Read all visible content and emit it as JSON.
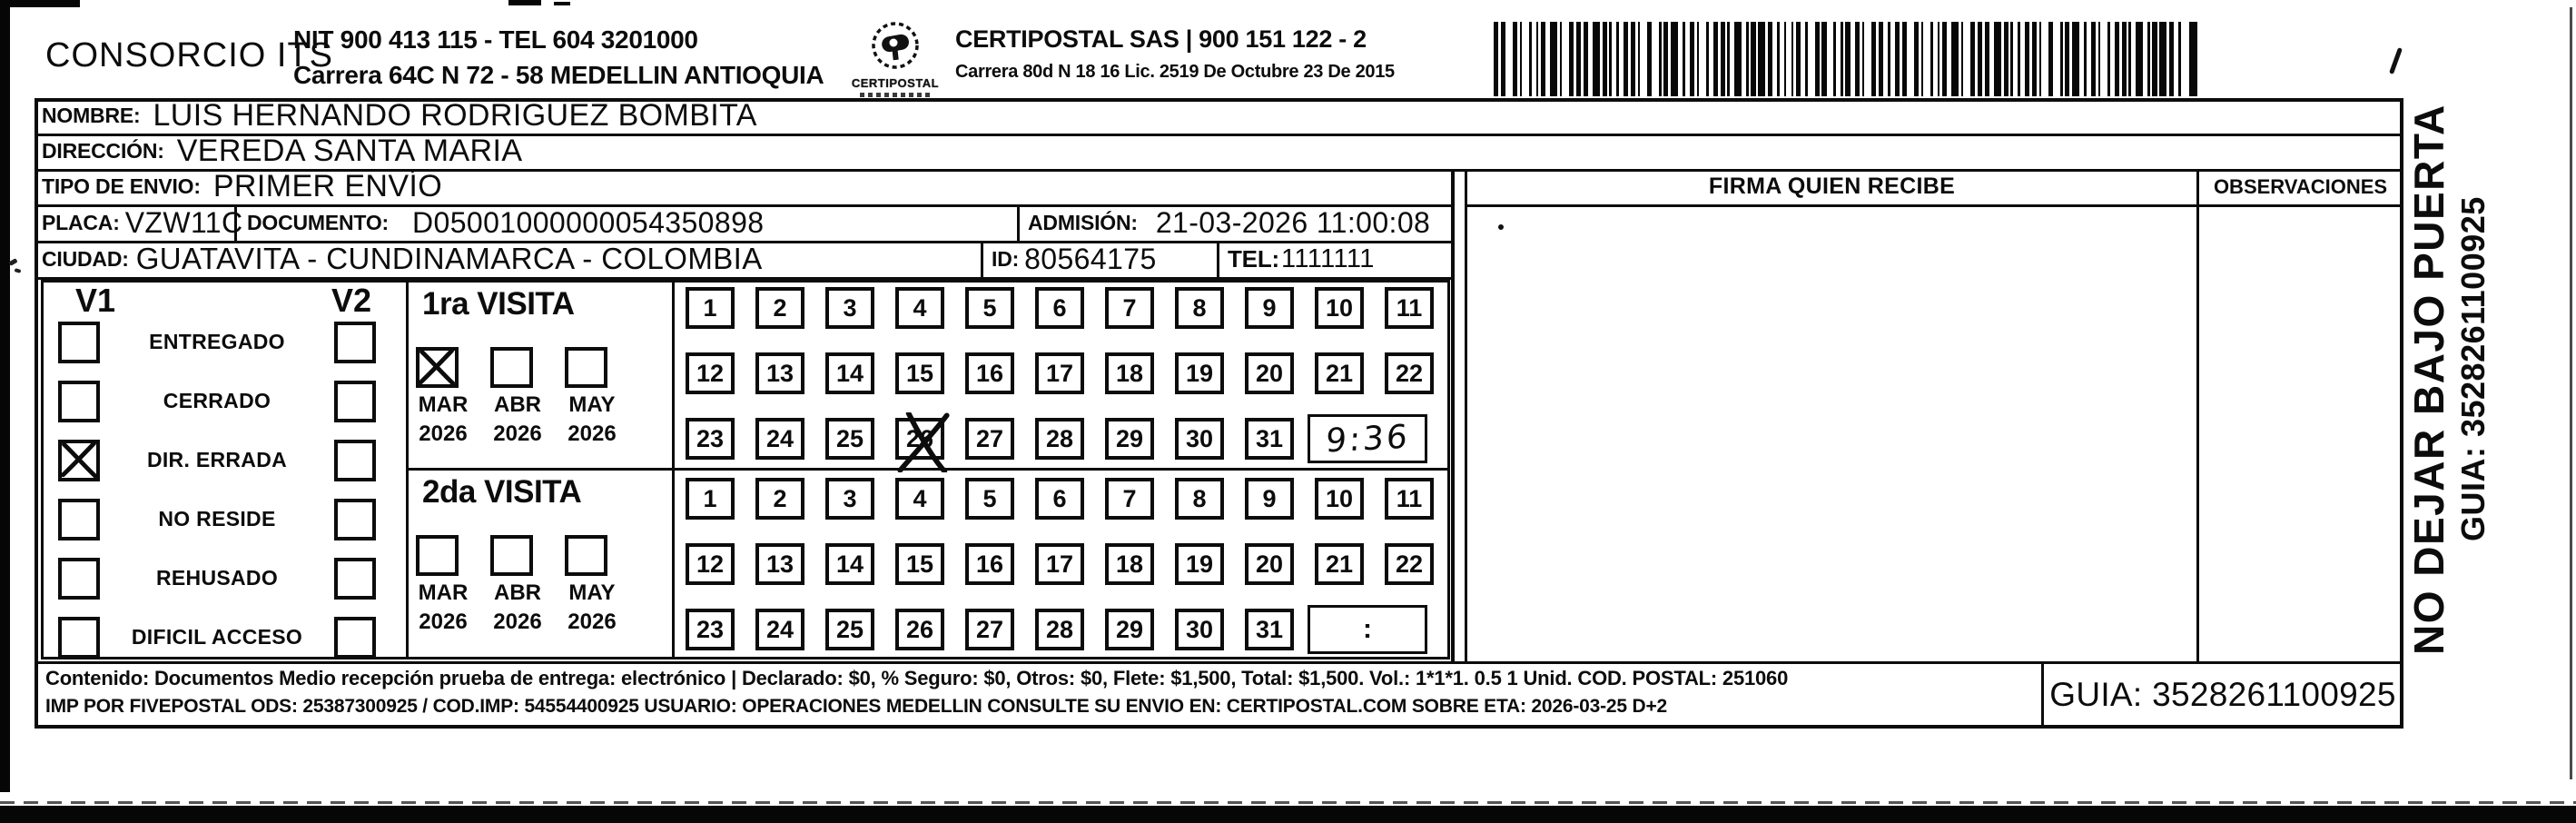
{
  "header": {
    "company_name": "CONSORCIO ITS",
    "nit_line": "NIT 900 413 115 - TEL 604 3201000",
    "address_line": "Carrera 64C N 72 - 58 MEDELLIN ANTIOQUIA",
    "logo_name": "CERTIPOSTAL",
    "operator_line": "CERTIPOSTAL SAS | 900 151 122 - 2",
    "operator_address": "Carrera 80d N 18 16  Lic. 2519 De Octubre 23 De 2015"
  },
  "shipment": {
    "nombre_label": "NOMBRE:",
    "nombre": "LUIS HERNANDO RODRIGUEZ BOMBITA",
    "direccion_label": "DIRECCIÓN:",
    "direccion": "VEREDA SANTA MARIA",
    "tipo_envio_label": "TIPO DE ENVIO:",
    "tipo_envio": "PRIMER ENVÍO",
    "placa_label": "PLACA:",
    "placa": "VZW11C",
    "documento_label": "DOCUMENTO:",
    "documento": "D05001000000054350898",
    "admision_label": "ADMISIÓN:",
    "admision": "21-03-2026 11:00:08",
    "ciudad_label": "CIUDAD:",
    "ciudad": "GUATAVITA - CUNDINAMARCA - COLOMBIA",
    "id_label": "ID:",
    "id_value": "80564175",
    "tel_label": "TEL:",
    "tel": "1111111"
  },
  "columns": {
    "firma_header": "FIRMA QUIEN RECIBE",
    "observaciones_header": "OBSERVACIONES"
  },
  "status_panel": {
    "col1": "V1",
    "col2": "V2",
    "options": [
      {
        "label": "ENTREGADO",
        "v1_checked": false,
        "v2_checked": false
      },
      {
        "label": "CERRADO",
        "v1_checked": false,
        "v2_checked": false
      },
      {
        "label": "DIR. ERRADA",
        "v1_checked": true,
        "v2_checked": false
      },
      {
        "label": "NO RESIDE",
        "v1_checked": false,
        "v2_checked": false
      },
      {
        "label": "REHUSADO",
        "v1_checked": false,
        "v2_checked": false
      },
      {
        "label": "DIFICIL ACCESO",
        "v1_checked": false,
        "v2_checked": false
      }
    ]
  },
  "visits": [
    {
      "title": "1ra VISITA",
      "months": [
        {
          "month": "MAR",
          "year": "2026",
          "checked": true
        },
        {
          "month": "ABR",
          "year": "2026",
          "checked": false
        },
        {
          "month": "MAY",
          "year": "2026",
          "checked": false
        }
      ],
      "days": [
        1,
        2,
        3,
        4,
        5,
        6,
        7,
        8,
        9,
        10,
        11,
        12,
        13,
        14,
        15,
        16,
        17,
        18,
        19,
        20,
        21,
        22,
        23,
        24,
        25,
        26,
        27,
        28,
        29,
        30,
        31
      ],
      "crossed_day": 26,
      "time_value": "9:36",
      "time_handwritten": true
    },
    {
      "title": "2da VISITA",
      "months": [
        {
          "month": "MAR",
          "year": "2026",
          "checked": false
        },
        {
          "month": "ABR",
          "year": "2026",
          "checked": false
        },
        {
          "month": "MAY",
          "year": "2026",
          "checked": false
        }
      ],
      "days": [
        1,
        2,
        3,
        4,
        5,
        6,
        7,
        8,
        9,
        10,
        11,
        12,
        13,
        14,
        15,
        16,
        17,
        18,
        19,
        20,
        21,
        22,
        23,
        24,
        25,
        26,
        27,
        28,
        29,
        30,
        31
      ],
      "crossed_day": null,
      "time_value": ":",
      "time_handwritten": false
    }
  ],
  "footer": {
    "content_line": "Contenido: Documentos Medio recepción prueba de entrega: electrónico | Declarado: $0, % Seguro: $0, Otros: $0, Flete: $1,500, Total: $1,500. Vol.: 1*1*1. 0.5 1 Unid. COD. POSTAL: 251060",
    "imp_line": "IMP POR FIVEPOSTAL ODS: 25387300925 / COD.IMP: 54554400925 USUARIO: OPERACIONES MEDELLIN CONSULTE SU ENVIO EN: CERTIPOSTAL.COM SOBRE ETA: 2026-03-25 D+2",
    "guia_label": "GUIA: 3528261100925"
  },
  "side_note": {
    "warning": "NO DEJAR BAJO PUERTA",
    "guia": "GUIA: 3528261100925"
  },
  "colors": {
    "ink": "#0c0c0c",
    "paper": "#ffffff"
  }
}
